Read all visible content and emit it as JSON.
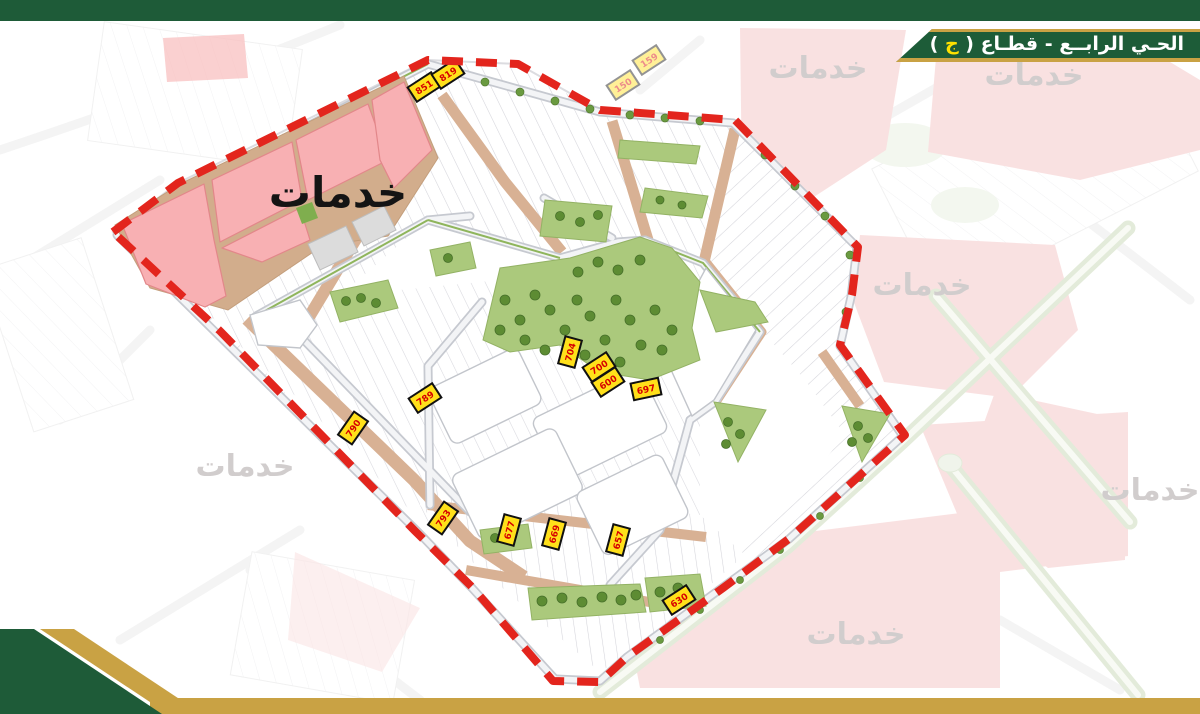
{
  "header": {
    "title_prefix": "الحـي الرابــع - قطـاع ( ",
    "sector_letter": "ج",
    "title_suffix": " )"
  },
  "map": {
    "main_service_label": "خدمات",
    "context_service_labels": [
      {
        "text": "خدمات",
        "x": 818,
        "y": 78
      },
      {
        "text": "خدمات",
        "x": 1034,
        "y": 85
      },
      {
        "text": "خدمات",
        "x": 922,
        "y": 295
      },
      {
        "text": "خدمات",
        "x": 1150,
        "y": 500
      },
      {
        "text": "خدمات",
        "x": 245,
        "y": 476
      },
      {
        "text": "خدمات",
        "x": 856,
        "y": 644
      }
    ],
    "plot_labels": [
      {
        "value": "851",
        "x": 424,
        "y": 87,
        "rot": -33
      },
      {
        "value": "819",
        "x": 448,
        "y": 74,
        "rot": -33
      },
      {
        "value": "704",
        "x": 570,
        "y": 352,
        "rot": -75
      },
      {
        "value": "700",
        "x": 599,
        "y": 367,
        "rot": -33
      },
      {
        "value": "600",
        "x": 608,
        "y": 382,
        "rot": -33
      },
      {
        "value": "697",
        "x": 646,
        "y": 389,
        "rot": -12
      },
      {
        "value": "790",
        "x": 353,
        "y": 428,
        "rot": -55
      },
      {
        "value": "789",
        "x": 425,
        "y": 398,
        "rot": -33
      },
      {
        "value": "793",
        "x": 443,
        "y": 518,
        "rot": -55
      },
      {
        "value": "677",
        "x": 509,
        "y": 530,
        "rot": -75
      },
      {
        "value": "669",
        "x": 554,
        "y": 534,
        "rot": -75
      },
      {
        "value": "657",
        "x": 618,
        "y": 540,
        "rot": -75
      },
      {
        "value": "630",
        "x": 679,
        "y": 600,
        "rot": -33
      },
      {
        "value": "159",
        "x": 649,
        "y": 60,
        "rot": -33,
        "faded": true
      },
      {
        "value": "150",
        "x": 623,
        "y": 85,
        "rot": -33,
        "faded": true
      }
    ],
    "colors": {
      "accent_green": "#1e5b38",
      "accent_gold": "#c9a244",
      "boundary_red": "#e3251d",
      "service_pink": "#f8b0b3",
      "road_tan": "#d8b194",
      "park_green": "#abc97c",
      "label_yellow": "#ffe01a"
    }
  }
}
